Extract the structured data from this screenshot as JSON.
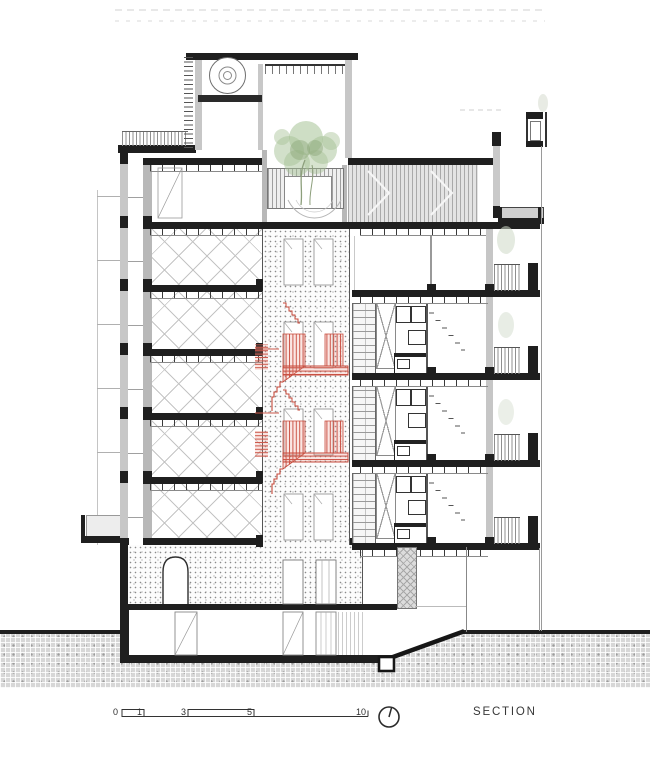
{
  "drawing": {
    "type": "architectural-section",
    "label": "SECTION",
    "scale_bar": {
      "labels": [
        "0",
        "1",
        "3",
        "5",
        "10"
      ]
    },
    "icons": [
      {
        "name": "north-orientation-icon",
        "glyph": "circle-with-needle"
      }
    ],
    "colors": {
      "ink": "#1f1f1f",
      "wall_gray": "#c7c7c7",
      "hatch_gray": "#9a9a9a",
      "ground_gray": "#d7d7d7",
      "stair_red": "#c6493a",
      "foliage_green": "#9cb789"
    }
  }
}
